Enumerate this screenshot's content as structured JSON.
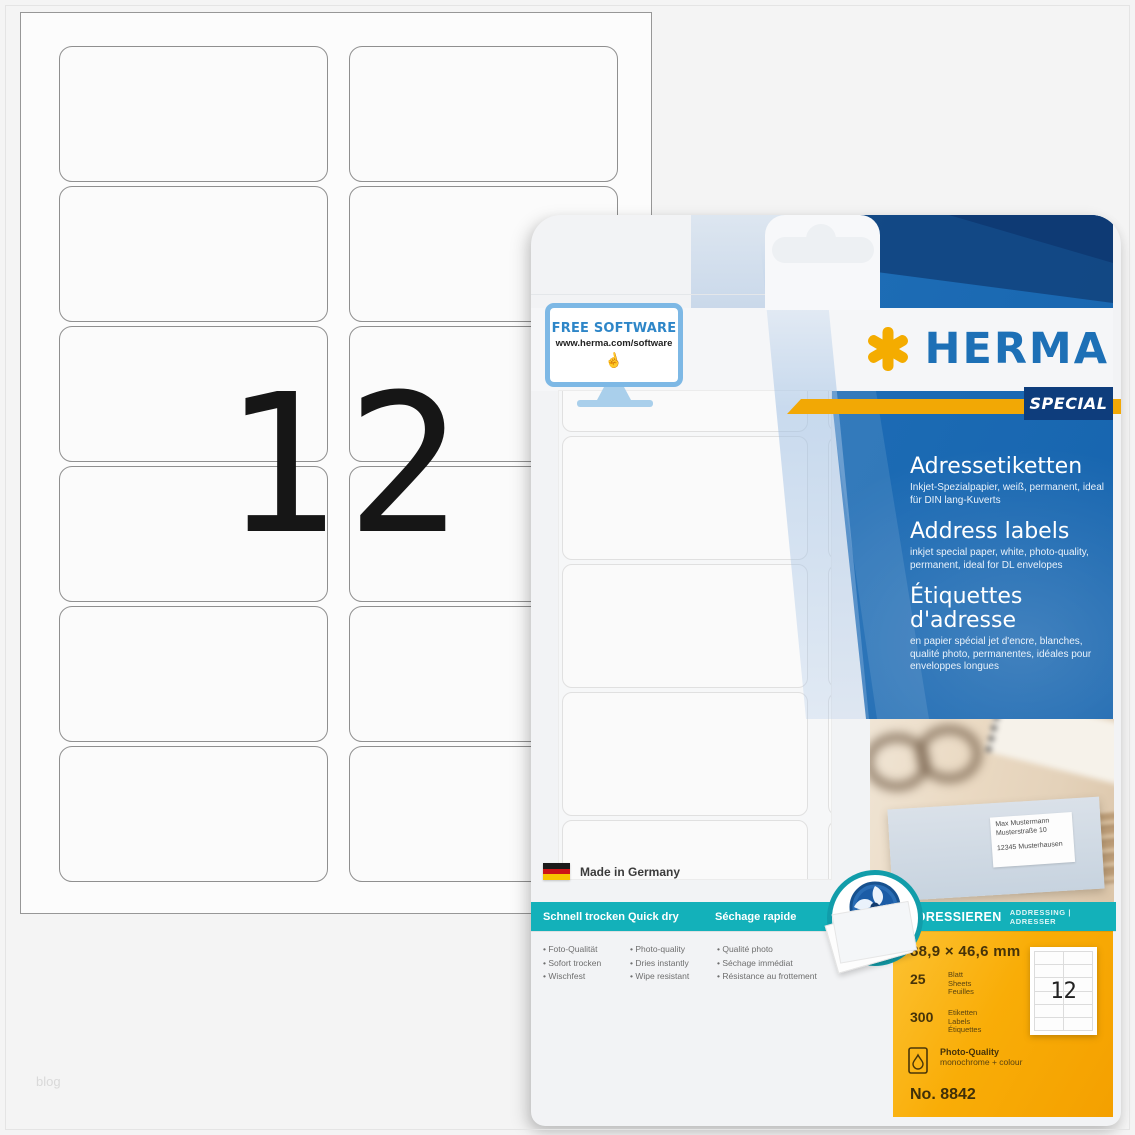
{
  "page": {
    "watermark": "blog"
  },
  "sheet": {
    "count_label": "12"
  },
  "package": {
    "free_software": {
      "title": "FREE SOFTWARE",
      "url": "www.herma.com/software"
    },
    "brand": {
      "name": "HERMA",
      "badge": "SPECIAL"
    },
    "product": {
      "de": {
        "title": "Adressetiketten",
        "desc": "Inkjet-Spezialpapier, weiß, permanent, ideal für DIN lang-Kuverts"
      },
      "en": {
        "title": "Address labels",
        "desc": "inkjet special paper, white, photo-quality, permanent, ideal for DL envelopes"
      },
      "fr": {
        "title": "Étiquettes d'adresse",
        "desc": "en papier spécial jet d'encre, blanches, qualité photo, permanentes, idéales pour enveloppes longues"
      }
    },
    "photo_label": {
      "line1": "Max Mustermann",
      "line2": "Musterstraße 10",
      "line3": "12345 Musterhausen"
    },
    "made_in": "Made in Germany",
    "quickdry": {
      "columns": [
        {
          "header": "Schnell trocken",
          "items": [
            "Foto-Qualität",
            "Sofort trocken",
            "Wischfest"
          ]
        },
        {
          "header": "Quick dry",
          "items": [
            "Photo-quality",
            "Dries instantly",
            "Wipe resistant"
          ]
        },
        {
          "header": "Séchage rapide",
          "items": [
            "Qualité photo",
            "Séchage immédiat",
            "Résistance au frottement"
          ]
        }
      ]
    },
    "addressing": {
      "primary": "ADRESSIEREN",
      "secondary": "ADDRESSING | ADRESSER"
    },
    "specs": {
      "size": "88,9 × 46,6 mm",
      "sheets": {
        "value": "25",
        "units": [
          "Blatt",
          "Sheets",
          "Feuilles"
        ]
      },
      "labels": {
        "value": "300",
        "units": [
          "Etiketten",
          "Labels",
          "Étiquettes"
        ]
      },
      "quality": {
        "title": "Photo-Quality",
        "desc": "monochrome + colour"
      },
      "article": "No. 8842",
      "mini_count": "12"
    }
  },
  "colors": {
    "teal": "#13b1ba",
    "blue": "#1d6cb5",
    "navy": "#0e3a74",
    "herma_blue": "#1d70b6",
    "yellow": "#f2a805",
    "orange": "#f9ad07"
  }
}
